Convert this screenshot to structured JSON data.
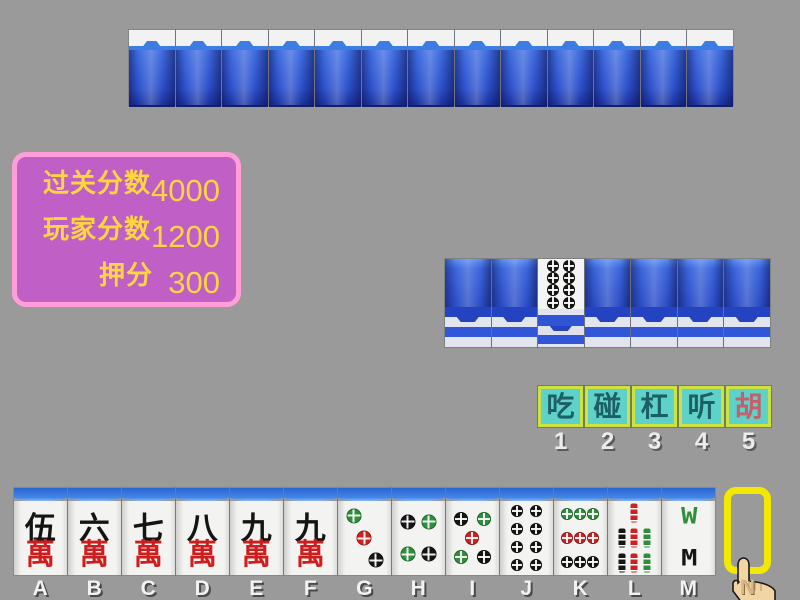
{
  "background_color": "#9a9a9a",
  "top_opponent": {
    "tile_count": 13
  },
  "score_panel": {
    "bg": "#c05fc5",
    "border": "#ff9ed9",
    "text_color": "#ffd540",
    "rows": [
      {
        "label": "过关分数",
        "value": "4000"
      },
      {
        "label": "玩家分数",
        "value": "1200"
      },
      {
        "label": "押分",
        "value": "300"
      }
    ]
  },
  "meld_row": {
    "tiles": [
      {
        "type": "back"
      },
      {
        "type": "back"
      },
      {
        "type": "face",
        "kind": "dots",
        "value": 8
      },
      {
        "type": "back"
      },
      {
        "type": "back"
      },
      {
        "type": "back"
      },
      {
        "type": "back"
      }
    ]
  },
  "action_bar": {
    "bg": "#5ed2c8",
    "border": "#cde23f",
    "buttons": [
      {
        "id": "chi",
        "label": "吃",
        "key": "1",
        "text_color": "#1e5f66"
      },
      {
        "id": "peng",
        "label": "碰",
        "key": "2",
        "text_color": "#1e5f66"
      },
      {
        "id": "gang",
        "label": "杠",
        "key": "3",
        "text_color": "#1e5f66"
      },
      {
        "id": "ting",
        "label": "听",
        "key": "4",
        "text_color": "#1e5f66"
      },
      {
        "id": "hu",
        "label": "胡",
        "key": "5",
        "text_color": "#c2606c"
      }
    ]
  },
  "hand": {
    "tiles": [
      {
        "letter": "A",
        "kind": "wan",
        "top": "伍",
        "bottom": "萬"
      },
      {
        "letter": "B",
        "kind": "wan",
        "top": "六",
        "bottom": "萬"
      },
      {
        "letter": "C",
        "kind": "wan",
        "top": "七",
        "bottom": "萬"
      },
      {
        "letter": "D",
        "kind": "wan",
        "top": "八",
        "bottom": "萬"
      },
      {
        "letter": "E",
        "kind": "wan",
        "top": "九",
        "bottom": "萬"
      },
      {
        "letter": "F",
        "kind": "wan",
        "top": "九",
        "bottom": "萬"
      },
      {
        "letter": "G",
        "kind": "dots",
        "value": 3
      },
      {
        "letter": "H",
        "kind": "dots",
        "value": 4
      },
      {
        "letter": "I",
        "kind": "dots",
        "value": 5
      },
      {
        "letter": "J",
        "kind": "dots",
        "value": 8
      },
      {
        "letter": "K",
        "kind": "dots",
        "value": 9
      },
      {
        "letter": "L",
        "kind": "bamboo",
        "value": 7
      },
      {
        "letter": "M",
        "kind": "bird",
        "top": "W",
        "bottom": "M"
      }
    ],
    "empty_slot_letter": "N"
  },
  "suit_colors": {
    "green": "#2f8f3c",
    "red": "#cc2222",
    "black": "#151515"
  },
  "dot_layouts": {
    "3": {
      "size": 15,
      "dots": [
        [
          30,
          20,
          "green"
        ],
        [
          50,
          50,
          "red"
        ],
        [
          72,
          80,
          "black"
        ]
      ]
    },
    "4": {
      "size": 15,
      "dots": [
        [
          30,
          28,
          "black"
        ],
        [
          70,
          28,
          "green"
        ],
        [
          30,
          72,
          "green"
        ],
        [
          70,
          72,
          "black"
        ]
      ]
    },
    "5": {
      "size": 14,
      "dots": [
        [
          28,
          24,
          "black"
        ],
        [
          72,
          24,
          "green"
        ],
        [
          50,
          50,
          "red"
        ],
        [
          28,
          76,
          "green"
        ],
        [
          72,
          76,
          "black"
        ]
      ]
    },
    "8": {
      "size": 12,
      "dots": [
        [
          32,
          13,
          "black"
        ],
        [
          68,
          13,
          "black"
        ],
        [
          32,
          38,
          "black"
        ],
        [
          68,
          38,
          "black"
        ],
        [
          32,
          62,
          "black"
        ],
        [
          68,
          62,
          "black"
        ],
        [
          32,
          87,
          "black"
        ],
        [
          68,
          87,
          "black"
        ]
      ]
    },
    "9": {
      "size": 12,
      "dots": [
        [
          25,
          18,
          "green"
        ],
        [
          50,
          18,
          "green"
        ],
        [
          75,
          18,
          "green"
        ],
        [
          25,
          50,
          "red"
        ],
        [
          50,
          50,
          "red"
        ],
        [
          75,
          50,
          "red"
        ],
        [
          25,
          82,
          "black"
        ],
        [
          50,
          82,
          "black"
        ],
        [
          75,
          82,
          "black"
        ]
      ]
    }
  },
  "bamboo_layouts": {
    "7": [
      [
        50,
        16,
        "red"
      ],
      [
        26,
        50,
        "black"
      ],
      [
        50,
        50,
        "red"
      ],
      [
        74,
        50,
        "green"
      ],
      [
        26,
        84,
        "black"
      ],
      [
        50,
        84,
        "red"
      ],
      [
        74,
        84,
        "green"
      ]
    ]
  }
}
